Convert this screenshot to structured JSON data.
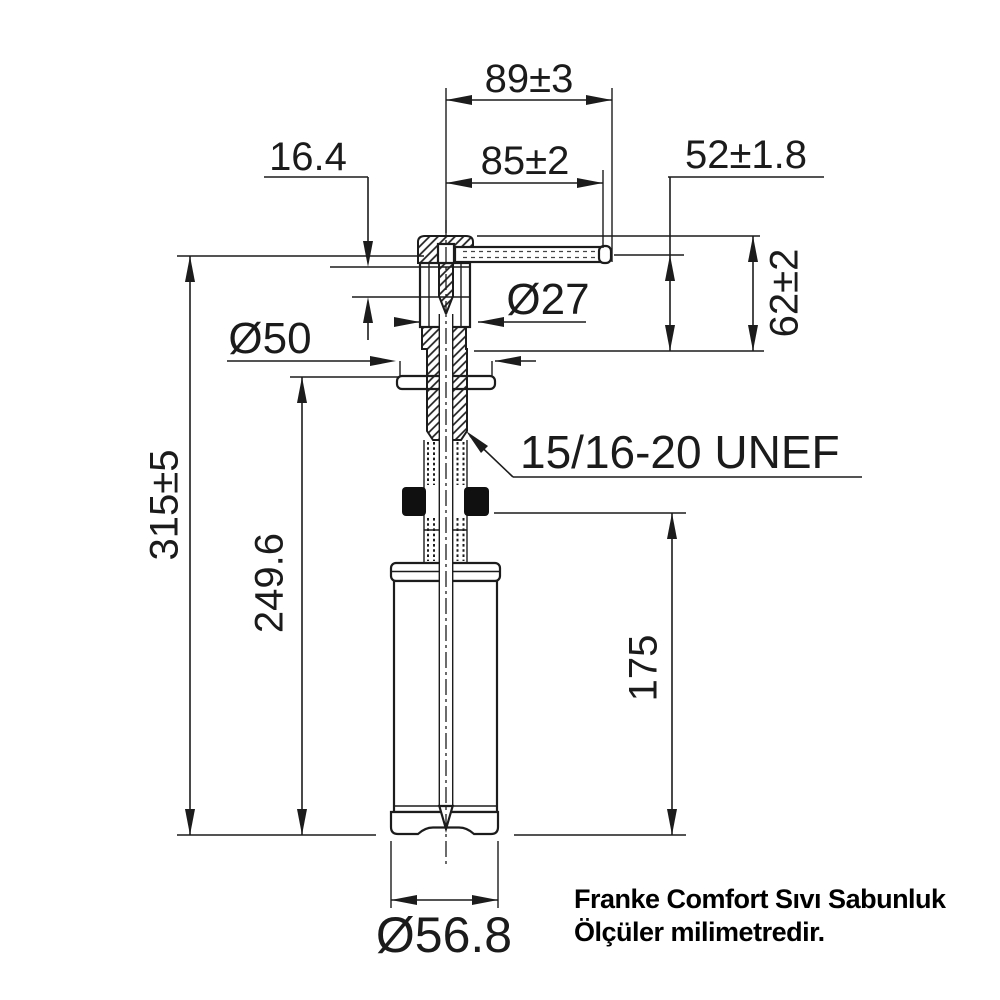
{
  "drawing_title": "Franke Comfort soap dispenser dimensional drawing",
  "units": "mm",
  "colors": {
    "line": "#1c1c1c",
    "background": "#ffffff",
    "nut": "#101010"
  },
  "dimensions": [
    {
      "id": "spout_projection_overall",
      "label": "89±3",
      "value_mm": 89,
      "tolerance_mm": 3,
      "kind": "linear-horizontal"
    },
    {
      "id": "spout_projection",
      "label": "85±2",
      "value_mm": 85,
      "tolerance_mm": 2,
      "kind": "linear-horizontal"
    },
    {
      "id": "outlet_height_above_deck",
      "label": "52±1.8",
      "value_mm": 52,
      "tolerance_mm": 1.8,
      "kind": "linear-vertical"
    },
    {
      "id": "head_height_above_deck",
      "label": "62±2",
      "value_mm": 62,
      "tolerance_mm": 2,
      "kind": "linear-vertical"
    },
    {
      "id": "pump_stroke",
      "label": "16.4",
      "value_mm": 16.4,
      "tolerance_mm": null,
      "kind": "linear-vertical"
    },
    {
      "id": "body_diameter",
      "label": "Ø27",
      "value_mm": 27,
      "tolerance_mm": null,
      "kind": "diameter"
    },
    {
      "id": "flange_diameter",
      "label": "Ø50",
      "value_mm": 50,
      "tolerance_mm": null,
      "kind": "diameter"
    },
    {
      "id": "overall_height",
      "label": "315±5",
      "value_mm": 315,
      "tolerance_mm": 5,
      "kind": "linear-vertical"
    },
    {
      "id": "height_below_flange",
      "label": "249.6",
      "value_mm": 249.6,
      "tolerance_mm": null,
      "kind": "linear-vertical"
    },
    {
      "id": "bottle_clearance_height",
      "label": "175",
      "value_mm": 175,
      "tolerance_mm": null,
      "kind": "linear-vertical"
    },
    {
      "id": "bottle_diameter",
      "label": "Ø56.8",
      "value_mm": 56.8,
      "tolerance_mm": null,
      "kind": "diameter"
    },
    {
      "id": "mounting_thread",
      "label": "15/16-20 UNEF",
      "value_mm": null,
      "tolerance_mm": null,
      "kind": "thread-spec"
    }
  ],
  "footer": {
    "line1": "Franke Comfort Sıvı Sabunluk",
    "line2": "Ölçüler milimetredir."
  }
}
